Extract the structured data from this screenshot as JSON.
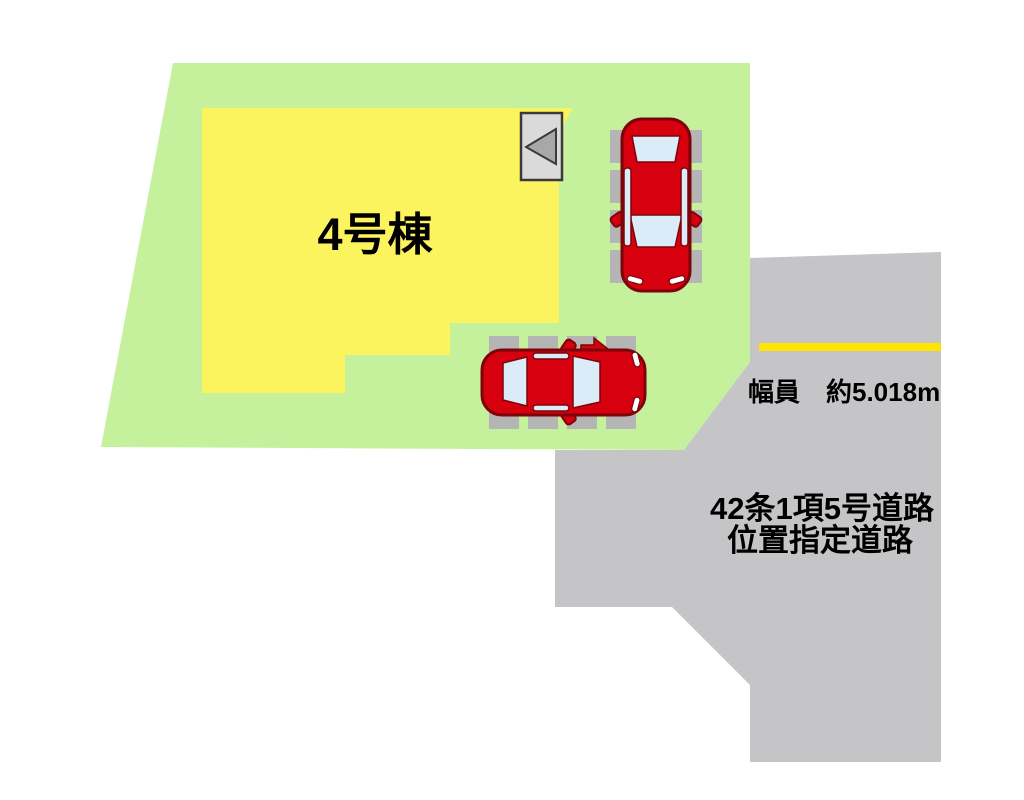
{
  "plot": {
    "building_label": "4号棟"
  },
  "road": {
    "width_label": "幅員　約5.018m",
    "name_line1": "42条1項5号道路",
    "name_line2": "位置指定道路"
  },
  "entrance_marker": {
    "icon": "left-triangle-icon",
    "direction": "left"
  },
  "parking": {
    "car_top": {
      "orientation": "vertical-front-down"
    },
    "car_bottom": {
      "orientation": "horizontal-front-right"
    }
  },
  "colors": {
    "background": "#ffffff",
    "plot_green": "#c5f09c",
    "building_yellow": "#fcf45e",
    "road_gray": "#c5c5c7",
    "road_line_yellow": "#ffe400",
    "car_red": "#d6000f",
    "car_outline": "#7d0509",
    "car_window": "#dcebf8",
    "parking_pad_gray": "#b5b5b5",
    "marker_box_gray": "#dadada",
    "marker_triangle_gray": "#a8a8a8",
    "text_black": "#000000"
  }
}
